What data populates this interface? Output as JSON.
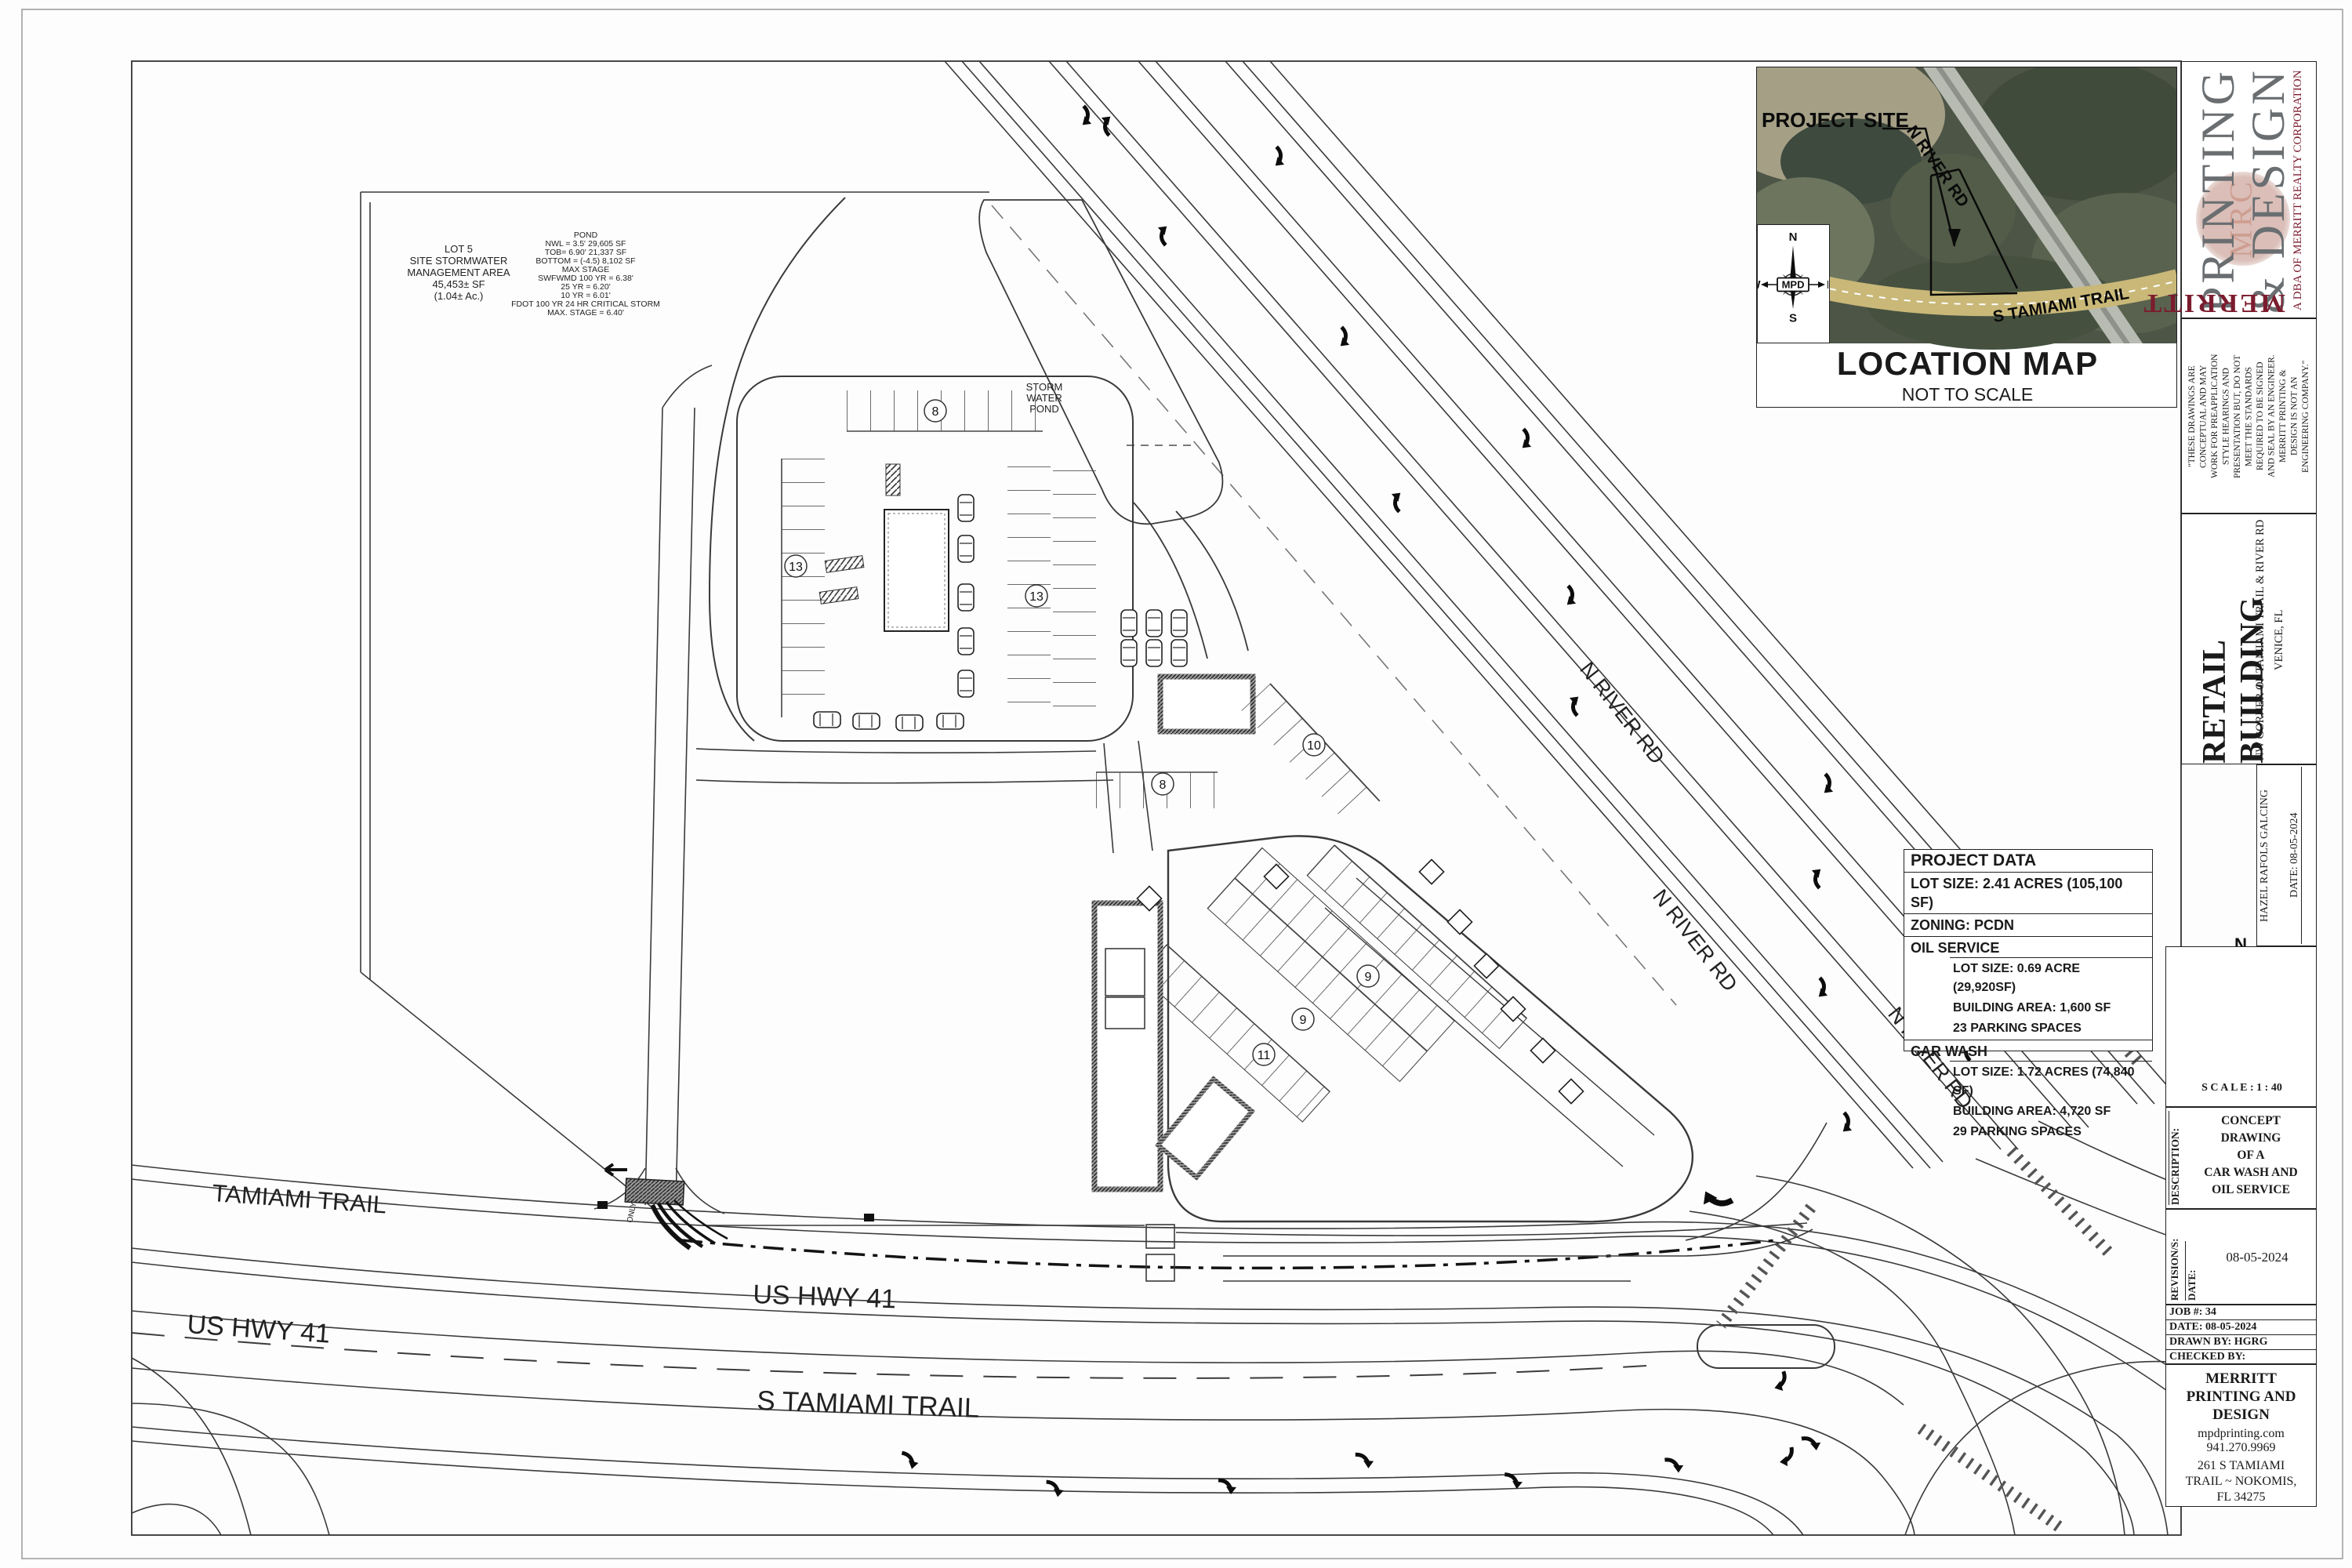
{
  "compass": {
    "n": "N",
    "s": "S",
    "e": "E",
    "w": "W",
    "center": "MPD"
  },
  "location_map": {
    "project_site": "PROJECT SITE",
    "n_river_rd": "N RIVER RD",
    "s_tamiami_trail": "S TAMIAMI TRAIL",
    "title": "LOCATION MAP",
    "subtitle": "NOT TO SCALE"
  },
  "titleblock": {
    "brand_printing": "PRINTING",
    "brand_design": "& DESIGN",
    "brand_merritt": "MERRITT",
    "brand_mrc": "MRC",
    "brand_dba": "A DBA OF MERRITT REALTY CORPORATION",
    "disclaimer": "\"THESE DRAWINGS ARE\nCONCEPTUAL AND MAY\nWORK FOR PREAPPLICATION\nSTYLE HEARINGS AND\nPRESENTATION BUT, DO NOT\nMEET THE STANDARDS\nREQUIRED TO BE SIGNED\nAND SEAL BY AN ENGINEER.\nMERRITT PRINTING &\nDESIGN IS NOT AN\nENGINEERING COMPANY.\"",
    "project_title": "RETAIL BUILDING",
    "project_sub1": "NW CORNER OF TAMIAMI TRAIL & RIVER RD",
    "project_sub2": "VENICE, FL",
    "author": "HAZEL RAFOLS GALCING",
    "author_date": "DATE: 08-05-2024",
    "scale_label": "S C A L E :  1  :  40",
    "description_label": "DESCRIPTION:",
    "description": "CONCEPT\nDRAWING\nOF A\nCAR WASH AND\nOIL SERVICE",
    "revisions_label": "REVISION/S:",
    "revision_date_label": "DATE:",
    "revision_date": "08-05-2024",
    "job": "JOB #: 34",
    "date": "DATE: 08-05-2024",
    "drawn_by": "DRAWN BY:   HGRG",
    "checked_by": "CHECKED BY:",
    "company": "MERRITT\nPRINTING AND\nDESIGN",
    "website": "mpdprinting.com",
    "phone": "941.270.9969",
    "address": "261 S TAMIAMI\nTRAIL ~ NOKOMIS,\nFL 34275"
  },
  "project_data": {
    "header": "PROJECT DATA",
    "lot_size": "LOT SIZE: 2.41 ACRES (105,100 SF)",
    "zoning": "ZONING:  PCDN",
    "oil_label": "OIL SERVICE",
    "oil_lot": "LOT SIZE: 0.69 ACRE (29,920SF)",
    "oil_area": "BUILDING AREA: 1,600 SF",
    "oil_parking": "23 PARKING SPACES",
    "cw_label": "CAR WASH",
    "cw_lot": "LOT SIZE: 1.72 ACRES (74,840 SF)",
    "cw_area": "BUILDING AREA: 4,720 SF",
    "cw_parking": "29 PARKING SPACES"
  },
  "plan": {
    "lot5": {
      "l0": "LOT 5",
      "l1": "SITE STORMWATER",
      "l2": "MANAGEMENT AREA",
      "l3": "45,453± SF",
      "l4": "(1.04± Ac.)"
    },
    "pond": {
      "l0": "POND",
      "l1": "NWL = 3.5'  29,605  SF",
      "l2": "TOB= 6.90'  21,337 SF",
      "l3": "BOTTOM = (-4.5)  8,102  SF",
      "l4": "MAX STAGE",
      "l5": "SWFWMD 100 YR = 6.38'",
      "l6": "25 YR = 6.20'",
      "l7": "10 YR = 6.01'",
      "l8": "FDOT 100 YR 24 HR CRITICAL STORM",
      "l9": "MAX. STAGE = 6.40'"
    },
    "storm_pond": {
      "l0": "STORM",
      "l1": "WATER",
      "l2": "POND"
    },
    "roads": {
      "tamiami_trail": "TAMIAMI TRAIL",
      "us_hwy_41": "US HWY 41",
      "s_tamiami_trail": "S TAMIAMI TRAIL",
      "n_river_rd": "N RIVER RD"
    },
    "counts": {
      "north_top": "8",
      "north_left": "13",
      "north_right": "13",
      "oil_row": "8",
      "oil_diag": "10",
      "cw_row1": "11",
      "cw_row2": "9",
      "cw_row3": "9"
    },
    "only": "ONLY"
  },
  "colors": {
    "line": "#2e2e2e",
    "brand_red": "#7b1c2e",
    "brand_gray": "#6a6e71",
    "map_green": "#4d5546",
    "map_road_tan": "#c9b878"
  }
}
